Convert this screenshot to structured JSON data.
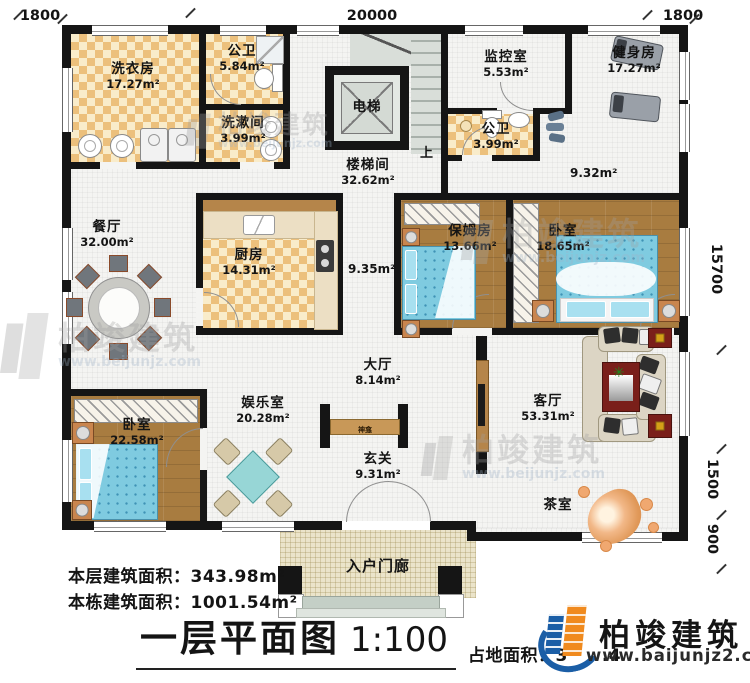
{
  "plan": {
    "title": "一层平面图",
    "scale": "1:100",
    "dims": {
      "top_left": "1800",
      "top_center": "20000",
      "top_right": "1800",
      "right_upper": "15700",
      "right_mid": "1500",
      "right_lower": "900"
    },
    "labels": {
      "up": "上",
      "shrine": "神龛",
      "corridor_left": "9.35m²",
      "corridor_right": "9.32m²"
    },
    "rooms": [
      {
        "name": "洗衣房",
        "area": "17.27m²"
      },
      {
        "name": "公卫",
        "area": "5.84m²"
      },
      {
        "name": "洗漱间",
        "area": "3.99m²"
      },
      {
        "name": "电梯",
        "area": ""
      },
      {
        "name": "楼梯间",
        "area": "32.62m²"
      },
      {
        "name": "监控室",
        "area": "5.53m²"
      },
      {
        "name": "公卫",
        "area": "3.99m²"
      },
      {
        "name": "健身房",
        "area": "17.27m²"
      },
      {
        "name": "餐厅",
        "area": "32.00m²"
      },
      {
        "name": "厨房",
        "area": "14.31m²"
      },
      {
        "name": "保姆房",
        "area": "13.66m²"
      },
      {
        "name": "卧室",
        "area": "18.65m²"
      },
      {
        "name": "卧室",
        "area": "22.58m²"
      },
      {
        "name": "娱乐室",
        "area": "20.28m²"
      },
      {
        "name": "大厅",
        "area": "8.14m²"
      },
      {
        "name": "玄关",
        "area": "9.31m²"
      },
      {
        "name": "客厅",
        "area": "53.31m²"
      },
      {
        "name": "茶室",
        "area": ""
      },
      {
        "name": "入户门廊",
        "area": ""
      }
    ]
  },
  "footer": {
    "floor_area_label": "本层建筑面积：",
    "floor_area_value": "343.98m²",
    "building_area_label": "本栋建筑面积：",
    "building_area_value": "1001.54m²",
    "land_area_label": "占地面积：",
    "land_area_fragment": "3",
    "land_area_fragment2": ".4"
  },
  "logo": {
    "name": "柏竣建筑",
    "url": "www.baijunjz2.com"
  },
  "watermark": {
    "name": "柏竣建筑",
    "url": "www.beijunjz.com"
  },
  "colors": {
    "wall": "#151515",
    "tile": "#ecc07c",
    "wood": "#a87c40",
    "bed_blue": "#7fcbe0",
    "accent_red": "#7a1f1a",
    "logo_blue": "#1b5ea6",
    "logo_orange": "#f08a1e"
  }
}
